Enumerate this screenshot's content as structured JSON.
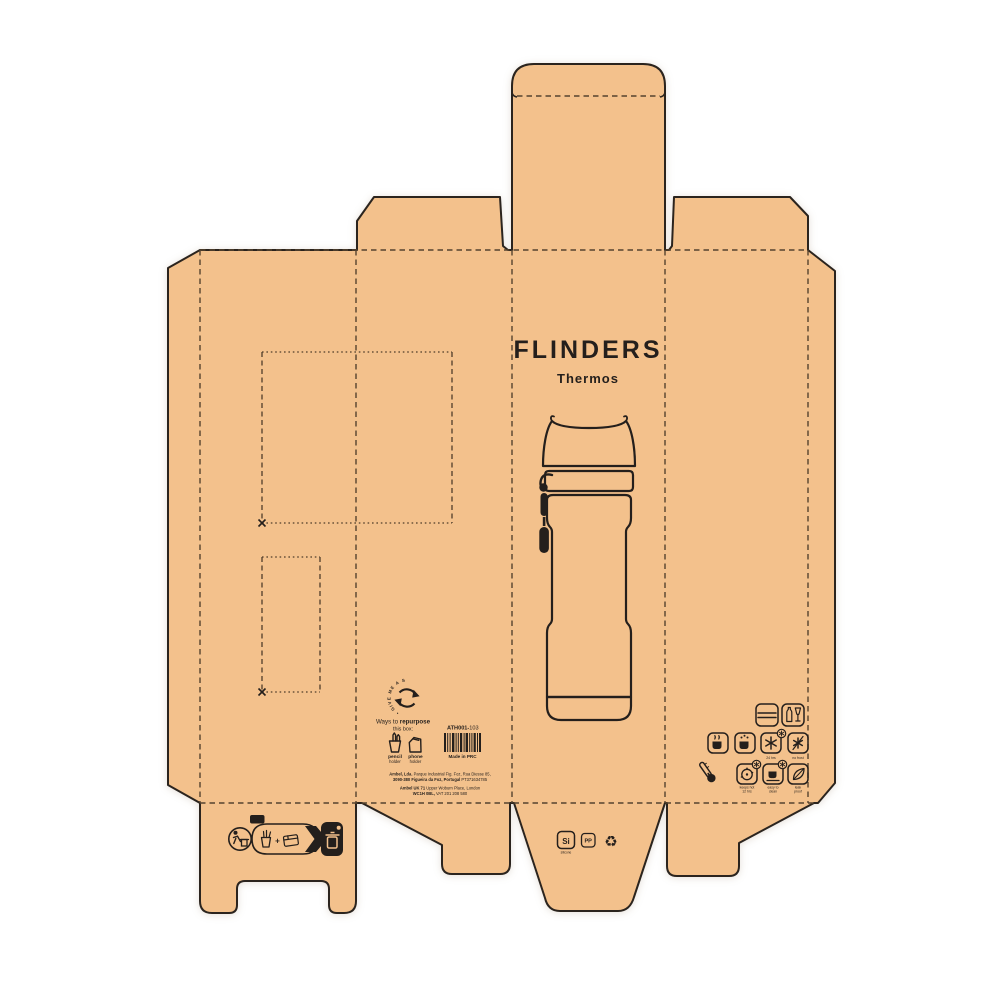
{
  "colors": {
    "board": "#f3c18c",
    "ink": "#241f1c",
    "fold": "#55432f"
  },
  "front_panel": {
    "brand": "FLINDERS",
    "product": "Thermos"
  },
  "repurpose": {
    "circle_text": "• GIVE ME A SECOND LIFE ",
    "heading_prefix": "Ways to ",
    "heading_bold": "repurpose",
    "heading_line2": "this box:",
    "option1_label": "pencil",
    "option1_sub": "holder",
    "option2_label": "phone",
    "option2_sub": "holder"
  },
  "product_info": {
    "sku_bold": "ATH001-",
    "sku_suffix": "103",
    "origin": "Made in PRC"
  },
  "manufacturer": {
    "eu_line1_bold": "Ambel, Lda.",
    "eu_line1": " Parque Industrial Fig. Foz, Rua Diesse 85,",
    "eu_line2_bold": "3090-380 Figueira da Foz, Portugal",
    "eu_line2": " PT371634785",
    "uk_line1_bold": "Ambel UK 71",
    "uk_line1": " Upper Woburn Place, London",
    "uk_line2_bold": "WC1H 0BL,",
    "uk_line2": " VAT 201 208 580"
  },
  "features": {
    "cold_label": "24 hrs",
    "frost_label": "no frost",
    "hot_label1": "keeps hot",
    "hot_label2": "12 hrs",
    "clean_label1": "easy to",
    "clean_label2": "clean",
    "leak_label1": "leak",
    "leak_label2": "proof"
  },
  "materials": {
    "silicone_code": "Si",
    "silicone_label": "silicone",
    "plastic_code": "PP",
    "recycle_symbol": "♻"
  },
  "recycling": {
    "pap": "PAP",
    "plus": "+"
  }
}
